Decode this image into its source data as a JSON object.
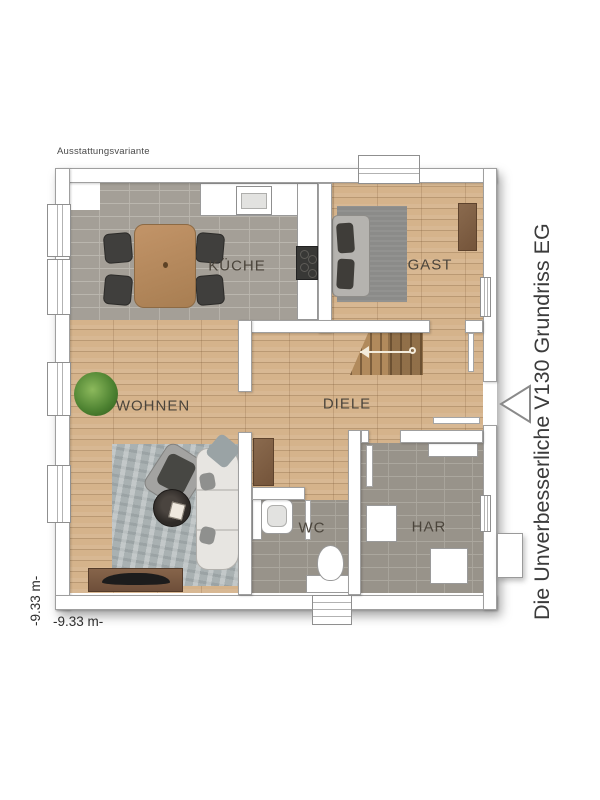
{
  "page": {
    "annotation": "Ausstattungsvariante",
    "title_vertical": "Die Unverbesserliche V130 Grundriss EG"
  },
  "dimensions": {
    "width_label": "-9.33 m-",
    "height_label": "-9.33 m-"
  },
  "rooms": {
    "kueche": {
      "label": "KÜCHE"
    },
    "gast": {
      "label": "GAST"
    },
    "wohnen": {
      "label": "WOHNEN"
    },
    "diele": {
      "label": "DIELE"
    },
    "wc": {
      "label": "WC"
    },
    "har": {
      "label": "HAR"
    }
  },
  "colors": {
    "wood_floor": "#d5b38b",
    "kitchen_tile": "#a49f97",
    "bath_tile": "#98938a",
    "wall": "#ffffff",
    "label_text": "#4b453c",
    "title_text": "#3b3b3b"
  }
}
